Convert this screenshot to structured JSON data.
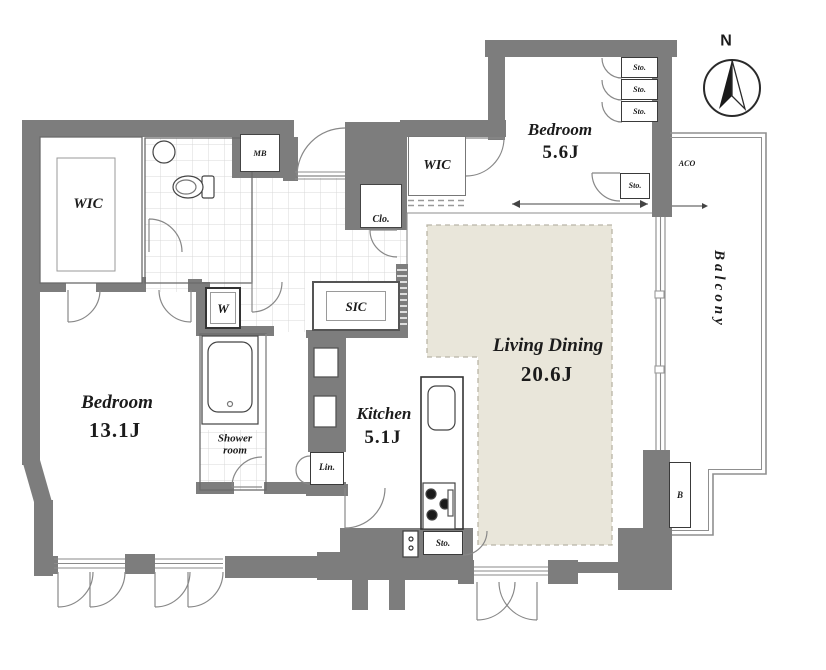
{
  "colors": {
    "wall": "#7d7d7d",
    "accent_floor": "#e9e6da",
    "line": "#6b6b6b",
    "tile_line": "#d9d9d9",
    "text": "#1b1b1b"
  },
  "compass": {
    "label": "N"
  },
  "rooms": {
    "bedroom_right": {
      "name": "Bedroom",
      "size": "5.6J"
    },
    "bedroom_left": {
      "name": "Bedroom",
      "size": "13.1J"
    },
    "living_dining": {
      "name": "Living Dining",
      "size": "20.6J"
    },
    "kitchen": {
      "name": "Kitchen",
      "size": "5.1J"
    },
    "balcony": {
      "name": "Balcony"
    },
    "shower_room": {
      "name": "Shower room"
    },
    "wic_left": {
      "label": "WIC"
    },
    "wic_right": {
      "label": "WIC"
    },
    "sic": {
      "label": "SIC"
    }
  },
  "closets": {
    "sto": "Sto.",
    "clo": "Clo.",
    "lin": "Lin."
  },
  "utility": {
    "mb": "MB",
    "aco": "ACO",
    "w": "W",
    "b": "B"
  }
}
